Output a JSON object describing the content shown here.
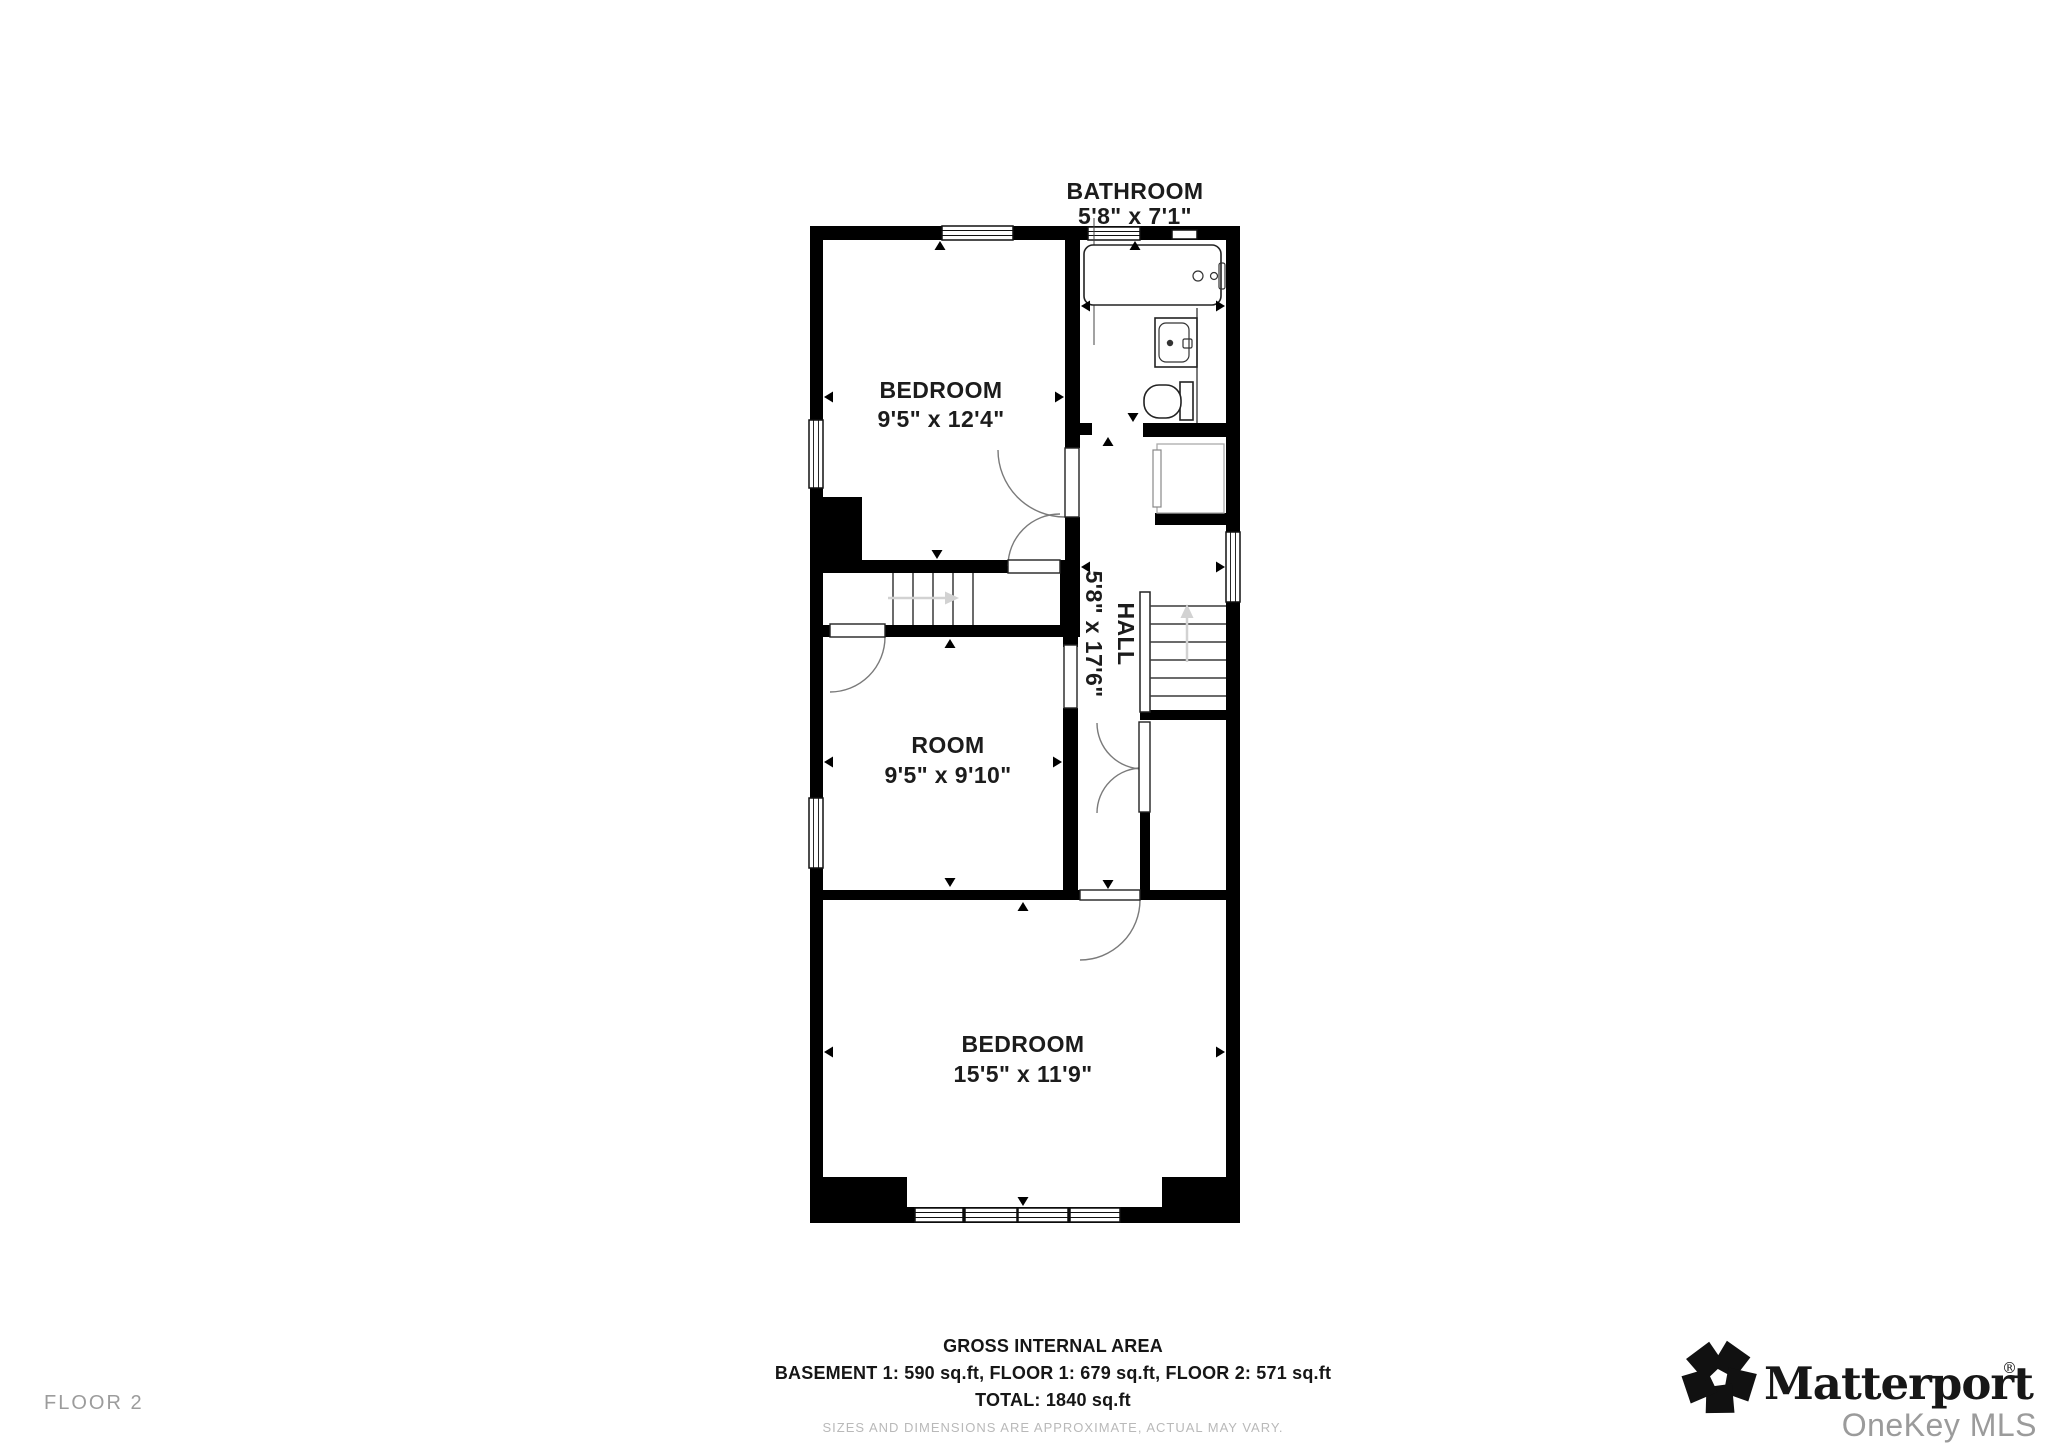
{
  "floor_label": "FLOOR 2",
  "plan": {
    "rooms": [
      {
        "name": "BATHROOM",
        "dims": "5'8\" x 7'1\""
      },
      {
        "name": "BEDROOM",
        "dims": "9'5\" x 12'4\""
      },
      {
        "name": "HALL",
        "dims": "5'8\" x 17'6\""
      },
      {
        "name": "ROOM",
        "dims": "9'5\" x 9'10\""
      },
      {
        "name": "BEDROOM",
        "dims": "15'5\" x 11'9\""
      }
    ]
  },
  "footer": {
    "title": "GROSS INTERNAL AREA",
    "areas": "BASEMENT 1: 590 sq.ft, FLOOR 1: 679 sq.ft, FLOOR 2: 571 sq.ft",
    "total": "TOTAL: 1840 sq.ft",
    "disclaimer": "SIZES AND DIMENSIONS ARE APPROXIMATE, ACTUAL MAY VARY."
  },
  "branding": {
    "wordmark": "Matterport",
    "registered": "®",
    "sub_brand": "OneKey MLS"
  },
  "colors": {
    "wall": "#000000",
    "label_text": "#1c1c1c",
    "muted_text": "#9c9c9c",
    "disclaimer_text": "#b9b9b9",
    "stair_arrow": "#d2d2d2"
  }
}
